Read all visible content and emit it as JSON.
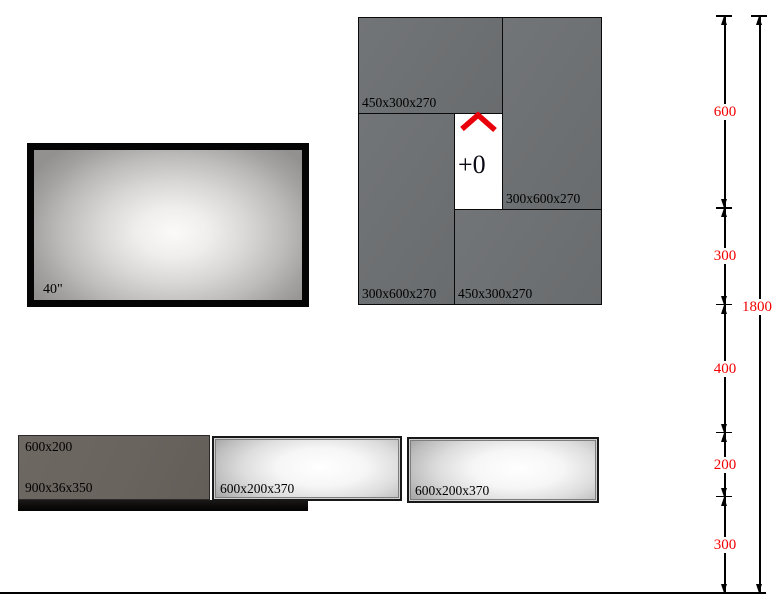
{
  "drawing": {
    "type": "furniture-elevation-diagram",
    "background": "#ffffff"
  },
  "tv": {
    "label": "40\""
  },
  "cabinets": {
    "fill_color": "#6e7173",
    "boxes": [
      {
        "id": "top-left",
        "label": "450x300x270"
      },
      {
        "id": "top-right",
        "label": "300x600x270"
      },
      {
        "id": "mid-left",
        "label": "300x600x270"
      },
      {
        "id": "bottom",
        "label": "450x300x270"
      }
    ],
    "gap": {
      "label": "+0",
      "marker": "chevron-up",
      "marker_color": "#e8000a"
    }
  },
  "shelves": {
    "left_cabinet": {
      "label_top": "600x200",
      "label_bottom": "900x36x350",
      "fill_color": "#6a645f"
    },
    "black_shelf": {
      "label": "900x36x350"
    },
    "units": [
      {
        "label": "600x200x370"
      },
      {
        "label": "600x200x370"
      }
    ]
  },
  "dimensions": {
    "color": "#f40000",
    "unit": "mm",
    "segments": [
      {
        "label": "600",
        "mm": 600
      },
      {
        "label": "300",
        "mm": 300
      },
      {
        "label": "400",
        "mm": 400
      },
      {
        "label": "200",
        "mm": 200
      },
      {
        "label": "300",
        "mm": 300
      }
    ],
    "total": {
      "label": "1800",
      "mm": 1800
    }
  }
}
